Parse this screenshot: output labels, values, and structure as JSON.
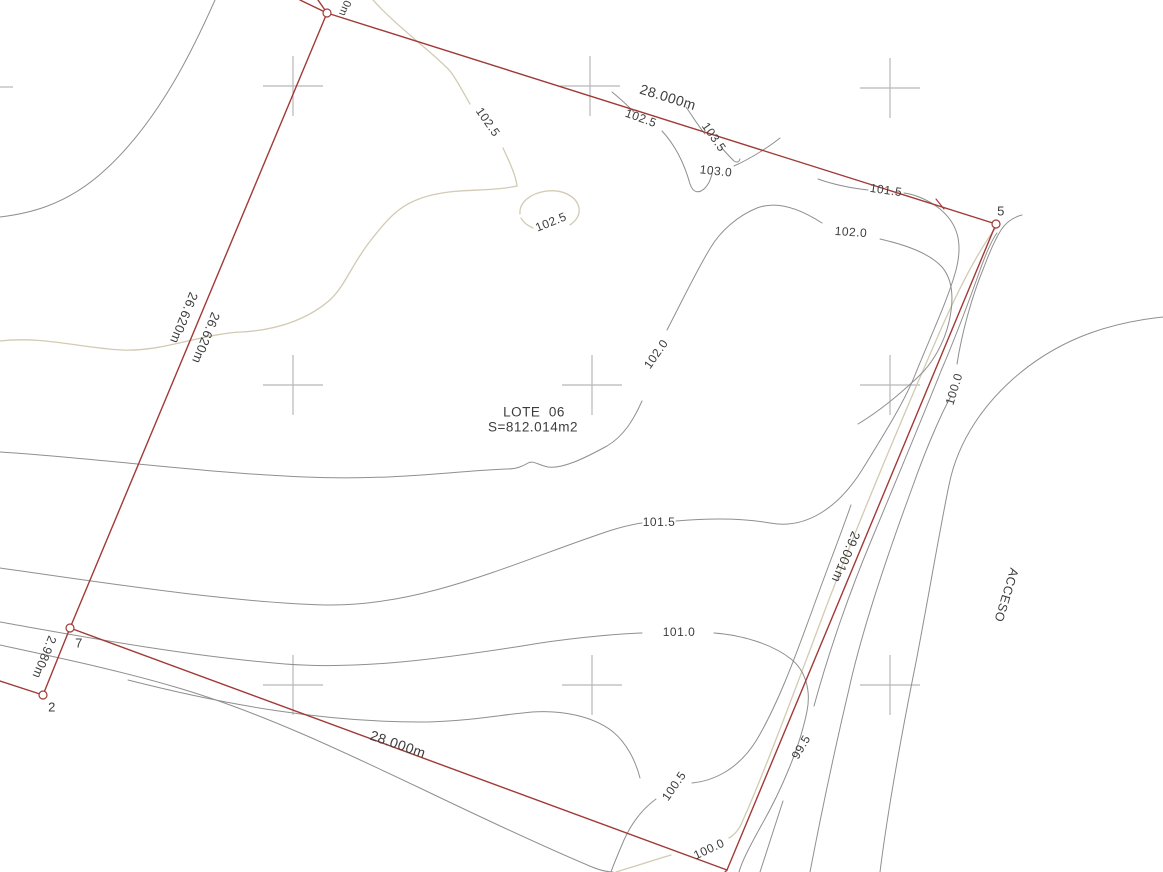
{
  "drawing": {
    "lot_title": "LOTE  06",
    "lot_area": "S=812.014m2",
    "road_label": "ACCESO",
    "boundary_dimensions": [
      "28.000m",
      "26.620m",
      "26.620m",
      "29.001m",
      "28.000m",
      "2.980m"
    ],
    "point_numbers": [
      "5",
      "7",
      "2"
    ],
    "contour_elevations": [
      "99.5",
      "100.0",
      "100.5",
      "101.0",
      "101.5",
      "102.0",
      "102.5",
      "103.0",
      "103.5"
    ],
    "colors": {
      "boundary_red": "#a03a36",
      "contour_gray": "#8f8f8f",
      "contour_tan": "#d2cab2",
      "grid_cross_gray": "#b8b8b8",
      "text": "#3d3d3d",
      "background": "#ffffff"
    }
  },
  "labels": [
    {
      "text": "0m",
      "kind": "dimension-fragment"
    },
    {
      "text": "28.000m",
      "kind": "dimension"
    },
    {
      "text": "102.5",
      "kind": "contour-elevation"
    },
    {
      "text": "103.5",
      "kind": "contour-elevation"
    },
    {
      "text": "103.0",
      "kind": "contour-elevation"
    },
    {
      "text": "102.5",
      "kind": "contour-elevation"
    },
    {
      "text": "102.5",
      "kind": "contour-elevation"
    },
    {
      "text": "101.5",
      "kind": "contour-elevation"
    },
    {
      "text": "102.0",
      "kind": "contour-elevation"
    },
    {
      "text": "5",
      "kind": "point-number"
    },
    {
      "text": "26.620m",
      "kind": "dimension"
    },
    {
      "text": "26.620m",
      "kind": "dimension"
    },
    {
      "text": "LOTE  06",
      "kind": "lot-title"
    },
    {
      "text": "S=812.014m2",
      "kind": "lot-area"
    },
    {
      "text": "102.0",
      "kind": "contour-elevation"
    },
    {
      "text": "100.0",
      "kind": "contour-elevation"
    },
    {
      "text": "101.5",
      "kind": "contour-elevation"
    },
    {
      "text": "29.001m",
      "kind": "dimension"
    },
    {
      "text": "ACCESO",
      "kind": "road-name"
    },
    {
      "text": "101.0",
      "kind": "contour-elevation"
    },
    {
      "text": "7",
      "kind": "point-number"
    },
    {
      "text": "2.980m",
      "kind": "dimension"
    },
    {
      "text": "2",
      "kind": "point-number"
    },
    {
      "text": "28.000m",
      "kind": "dimension"
    },
    {
      "text": "99.5",
      "kind": "contour-elevation"
    },
    {
      "text": "100.5",
      "kind": "contour-elevation"
    },
    {
      "text": "100.0",
      "kind": "contour-elevation"
    }
  ]
}
